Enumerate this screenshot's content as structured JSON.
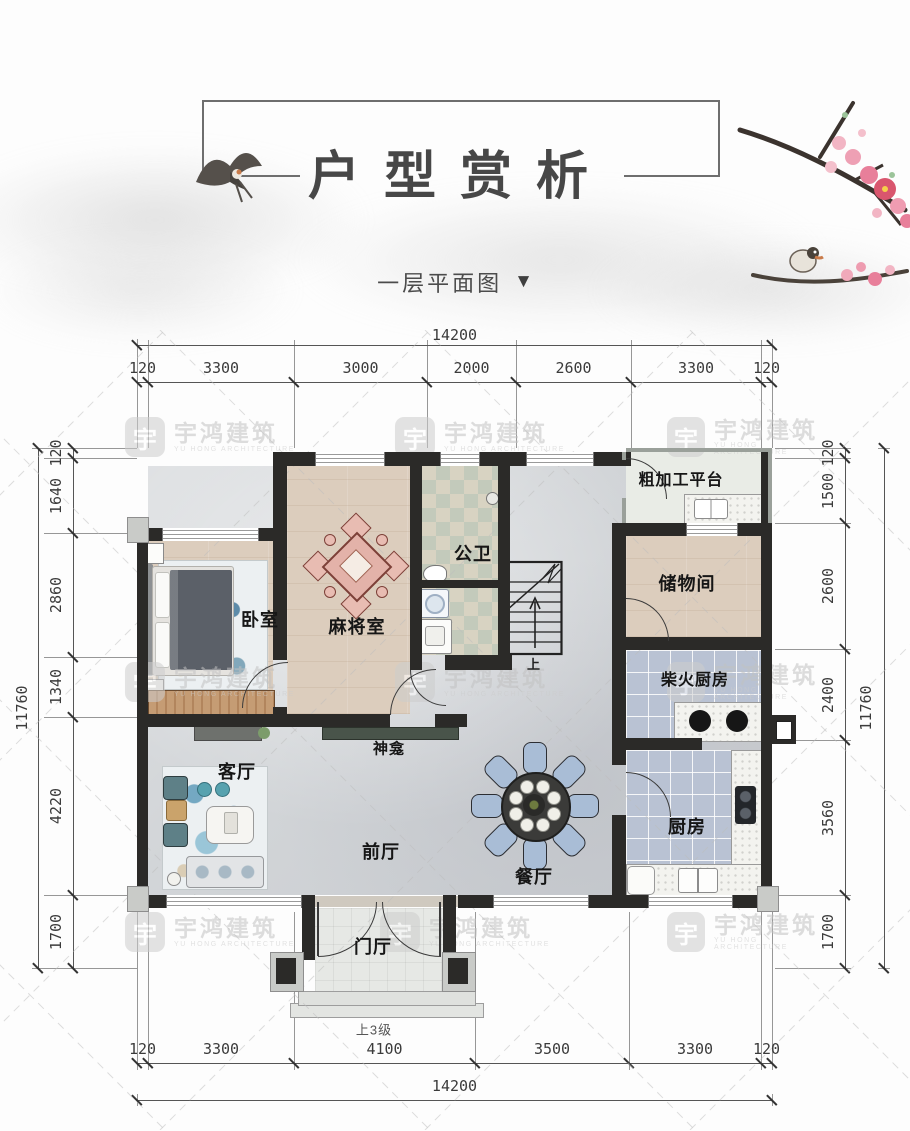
{
  "page": {
    "title": "户型赏析",
    "subtitle": "一层平面图",
    "subtitle_arrow": "▼"
  },
  "brand": {
    "logo_char": "宇",
    "name": "宇鸿建筑",
    "name_en": "YU HONG ARCHITECTURE"
  },
  "plan": {
    "rooms": [
      {
        "id": "bedroom",
        "label": "卧室"
      },
      {
        "id": "mahjong",
        "label": "麻将室"
      },
      {
        "id": "bath",
        "label": "公卫"
      },
      {
        "id": "platform",
        "label": "粗加工平台"
      },
      {
        "id": "storage",
        "label": "储物间"
      },
      {
        "id": "wood-kitchen",
        "label": "柴火厨房"
      },
      {
        "id": "kitchen",
        "label": "厨房"
      },
      {
        "id": "shrine",
        "label": "神龛"
      },
      {
        "id": "living",
        "label": "客厅"
      },
      {
        "id": "front-hall",
        "label": "前厅"
      },
      {
        "id": "dining",
        "label": "餐厅"
      },
      {
        "id": "entry",
        "label": "门厅"
      }
    ],
    "stair_up_label": "上",
    "steps_note": "上3级"
  },
  "dimensions": {
    "top": {
      "total": "14200",
      "segments": [
        "120",
        "3300",
        "3000",
        "2000",
        "2600",
        "3300",
        "120"
      ]
    },
    "bottom": {
      "total": "14200",
      "segments": [
        "120",
        "3300",
        "4100",
        "3500",
        "3300",
        "120"
      ]
    },
    "left": {
      "total": "11760",
      "segments": [
        "120",
        "1640",
        "2860",
        "1340",
        "4220",
        "1700"
      ]
    },
    "right": {
      "total": "11760",
      "segments": [
        "120",
        "1500",
        "2600",
        "2400",
        "3560",
        "1700"
      ]
    }
  },
  "colors": {
    "wall": "#2b2a28",
    "wood_floor": "#dccdbd",
    "marble_floor": "#d2d5d8",
    "kitchen_tile": "#b9c2d3",
    "bath_tile_a": "#c3cabb",
    "bath_tile_b": "#d8d3c2",
    "blossom_pink": "#f0a9ba",
    "blossom_red": "#d9566e",
    "watermark_gray": "#c8c8c8",
    "dim_text": "#3b3b3b"
  }
}
